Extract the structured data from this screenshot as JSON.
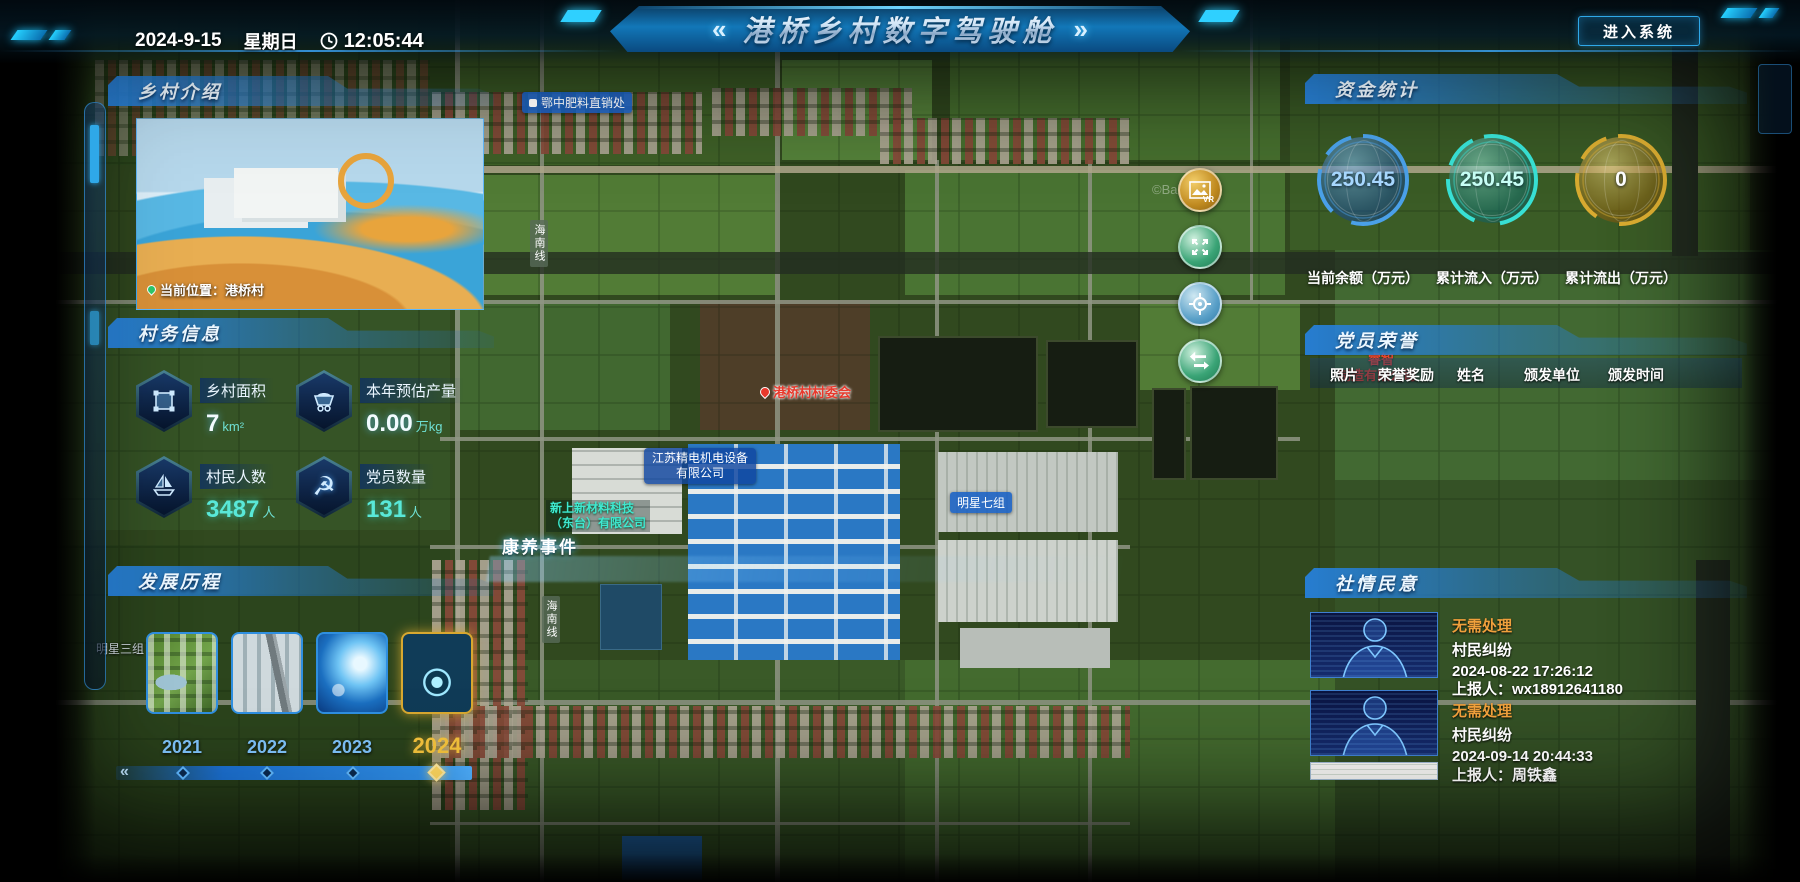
{
  "header": {
    "title": "港桥乡村数字驾驶舱",
    "chevron_left": "«",
    "chevron_right": "»",
    "date": "2024-9-15",
    "weekday": "星期日",
    "time": "12:05:44",
    "enter_button": "进入系统"
  },
  "left": {
    "intro": {
      "title": "乡村介绍",
      "photo_caption": "当前位置：港桥村"
    },
    "info": {
      "title": "村务信息",
      "stats": [
        {
          "label": "乡村面积",
          "value": "7",
          "unit": "km²",
          "icon": "area-icon"
        },
        {
          "label": "本年预估产量",
          "value": "0.00",
          "unit": "万kg",
          "icon": "cart-icon"
        },
        {
          "label": "村民人数",
          "value": "3487",
          "unit": "人",
          "icon": "boat-icon"
        },
        {
          "label": "党员数量",
          "value": "131",
          "unit": "人",
          "icon": "party-emblem-icon"
        }
      ]
    },
    "development": {
      "title": "发展历程",
      "years": [
        "2021",
        "2022",
        "2023",
        "2024"
      ],
      "selected_year": "2024",
      "thumbs": [
        "aerial-2021",
        "campus-2022",
        "tech-2023",
        "exhibit-2024"
      ]
    }
  },
  "right": {
    "funds": {
      "title": "资金统计",
      "gauges": [
        {
          "value": "250.45",
          "label": "当前余额（万元）",
          "color": "#4aa0e8"
        },
        {
          "value": "250.45",
          "label": "累计流入（万元）",
          "color": "#38e0d4"
        },
        {
          "value": "0",
          "label": "累计流出（万元）",
          "color": "#d8aa30"
        }
      ]
    },
    "honors": {
      "title": "党员荣誉",
      "columns": [
        "照片",
        "荣誉奖励",
        "姓名",
        "颁发单位",
        "颁发时间"
      ]
    },
    "sentiment": {
      "title": "社情民意",
      "items": [
        {
          "status": "无需处理",
          "type": "村民纠纷",
          "time": "2024-08-22 17:26:12",
          "reporter": "上报人：wx18912641180"
        },
        {
          "status": "无需处理",
          "type": "村民纠纷",
          "time": "2024-09-14 20:44:33",
          "reporter": "上报人：周铁鑫"
        }
      ]
    }
  },
  "map": {
    "event_label": "康养事件",
    "watermark": "©Baidu",
    "labels": {
      "fertilizer": "鄂中肥料直销处",
      "committee": "港桥村村委会",
      "company1_line1": "江苏精电机电设备",
      "company1_line2": "有限公司",
      "company2_line1": "新上新材料科技",
      "company2_line2": "（东台）有限公司",
      "group7": "明星七组",
      "group3": "明星三组",
      "road1": "海南线",
      "road2": "海南线",
      "redco_line1": "睿智",
      "redco_line2": "制造有限公司"
    },
    "controls": {
      "vr": "VR"
    }
  },
  "colors": {
    "accent_blue": "#2fa8e8",
    "cyan_value": "#59e8d8",
    "gold": "#f4c23c",
    "status_orange": "#f0a03c",
    "marker_red": "#e8392c"
  }
}
